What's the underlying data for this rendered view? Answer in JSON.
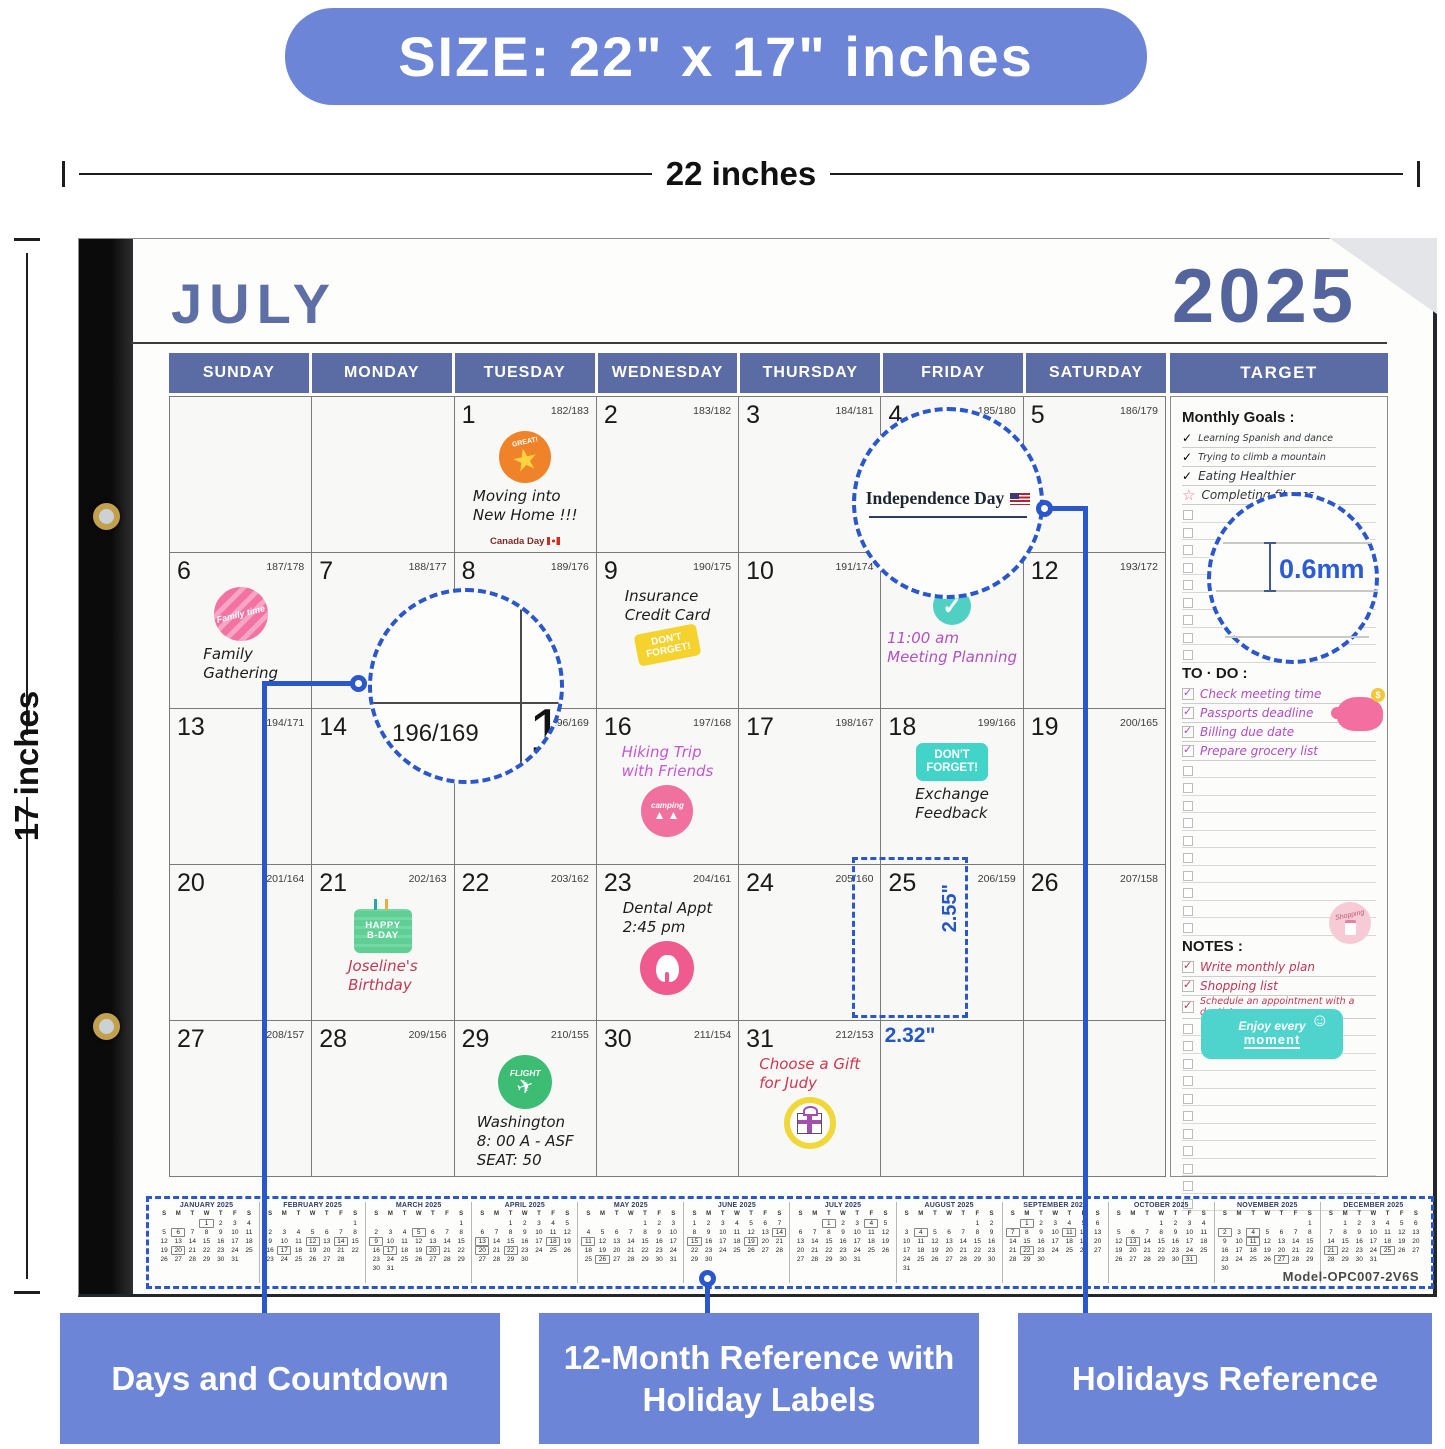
{
  "banner": {
    "text": "SIZE: 22\" x 17\" inches"
  },
  "dimensions": {
    "width_label": "22 inches",
    "height_label": "17 inches"
  },
  "calendar": {
    "month": "JULY",
    "year": "2025",
    "target_header": "TARGET",
    "day_headers": [
      "SUNDAY",
      "MONDAY",
      "TUESDAY",
      "WEDNESDAY",
      "THURSDAY",
      "FRIDAY",
      "SATURDAY"
    ],
    "weeks": [
      [
        null,
        null,
        {
          "day": "1",
          "countdown": "182/183",
          "event": {
            "sticker": "great-star",
            "lines": [
              "Moving into",
              "New Home !!!"
            ],
            "color": "#1c1c1c",
            "note": "Canada Day",
            "note_flag": "ca"
          }
        },
        {
          "day": "2",
          "countdown": "183/182"
        },
        {
          "day": "3",
          "countdown": "184/181"
        },
        {
          "day": "4",
          "countdown": "185/180"
        },
        {
          "day": "5",
          "countdown": "186/179"
        }
      ],
      [
        {
          "day": "6",
          "countdown": "187/178",
          "event": {
            "sticker": "family-time",
            "lines": [
              "Family",
              "Gathering"
            ],
            "color": "#1c1c1c"
          }
        },
        {
          "day": "7",
          "countdown": "188/177"
        },
        {
          "day": "8",
          "countdown": "189/176"
        },
        {
          "day": "9",
          "countdown": "190/175",
          "event": {
            "lines": [
              "Insurance",
              "Credit Card"
            ],
            "color": "#1c1c1c",
            "sticker": "dont-forget-yellow",
            "sticker_after": true
          }
        },
        {
          "day": "10",
          "countdown": "191/174"
        },
        {
          "day": "11",
          "countdown": "192/173",
          "event": {
            "sticker": "check-teal",
            "lines": [
              "11:00 am",
              "Meeting Planning"
            ],
            "color": "#b44fc4"
          }
        },
        {
          "day": "12",
          "countdown": "193/172"
        }
      ],
      [
        {
          "day": "13",
          "countdown": "194/171"
        },
        {
          "day": "14",
          "countdown": "195/170"
        },
        {
          "day": "15",
          "countdown": "196/169"
        },
        {
          "day": "16",
          "countdown": "197/168",
          "event": {
            "lines": [
              "Hiking Trip",
              "with Friends"
            ],
            "color": "#c455d6",
            "sticker": "camping",
            "sticker_after": true
          }
        },
        {
          "day": "17",
          "countdown": "198/167"
        },
        {
          "day": "18",
          "countdown": "199/166",
          "event": {
            "sticker": "dont-forget-teal",
            "lines": [
              "Exchange",
              "Feedback"
            ],
            "color": "#1c1c1c"
          }
        },
        {
          "day": "19",
          "countdown": "200/165"
        }
      ],
      [
        {
          "day": "20",
          "countdown": "201/164"
        },
        {
          "day": "21",
          "countdown": "202/163",
          "event": {
            "sticker": "bday-cake",
            "lines": [
              "Joseline's",
              "Birthday"
            ],
            "color": "#c13a54"
          }
        },
        {
          "day": "22",
          "countdown": "203/162"
        },
        {
          "day": "23",
          "countdown": "204/161",
          "event": {
            "lines": [
              "Dental Appt",
              "2:45 pm"
            ],
            "color": "#1c1c1c",
            "sticker": "tooth",
            "sticker_after": true
          }
        },
        {
          "day": "24",
          "countdown": "205/160"
        },
        {
          "day": "25",
          "countdown": "206/159"
        },
        {
          "day": "26",
          "countdown": "207/158"
        }
      ],
      [
        {
          "day": "27",
          "countdown": "208/157"
        },
        {
          "day": "28",
          "countdown": "209/156"
        },
        {
          "day": "29",
          "countdown": "210/155",
          "event": {
            "sticker": "flight",
            "lines": [
              "Washington",
              "8: 00 A  - ASF",
              "SEAT:  50"
            ],
            "color": "#1c1c1c"
          }
        },
        {
          "day": "30",
          "countdown": "211/154"
        },
        {
          "day": "31",
          "countdown": "212/153",
          "event": {
            "lines": [
              "Choose a Gift",
              "for Judy"
            ],
            "color": "#d2344e",
            "sticker": "gift",
            "sticker_after": true
          }
        },
        null,
        null
      ]
    ]
  },
  "target": {
    "monthly": {
      "title": "Monthly Goals :",
      "color": "#33383f",
      "empty_rows": 9,
      "items": [
        {
          "icon": "check",
          "text": "Learning Spanish and dance"
        },
        {
          "icon": "check",
          "text": "Trying to climb a mountain"
        },
        {
          "icon": "check",
          "text": "Eating Healthier"
        },
        {
          "icon": "star",
          "text": "Completing fitness"
        }
      ]
    },
    "todo": {
      "title": "TO · DO :",
      "color": "#b04cc2",
      "empty_rows": 10,
      "items": [
        "Check meeting time",
        "Passports deadline",
        "Billing due date",
        "Prepare grocery list"
      ]
    },
    "notes": {
      "title": "NOTES :",
      "color": "#c23553",
      "empty_rows": 11,
      "items": [
        "Write monthly plan",
        "Shopping list",
        "Schedule an appointment with a dentist"
      ],
      "badge": "Enjoy every moment"
    }
  },
  "annotations": {
    "independence": {
      "label": "Independence Day"
    },
    "magnifier": {
      "countdown": "196/169",
      "day": "16"
    },
    "thickness": {
      "label": "0.6mm"
    },
    "cell_size": {
      "width": "2.32\"",
      "height": "2.55\""
    },
    "callouts": [
      "Days and Countdown",
      "12-Month Reference with Holiday Labels",
      "Holidays Reference"
    ]
  },
  "mini_reference": {
    "dow": [
      "S",
      "M",
      "T",
      "W",
      "T",
      "F",
      "S"
    ],
    "model": "Model-OPC007-2V6S",
    "months": [
      {
        "name": "JANUARY 2025",
        "first": 3,
        "days": 31,
        "boxed": [
          1,
          6,
          20
        ]
      },
      {
        "name": "FEBRUARY 2025",
        "first": 6,
        "days": 28,
        "boxed": [
          12,
          14,
          17
        ]
      },
      {
        "name": "MARCH 2025",
        "first": 6,
        "days": 31,
        "boxed": [
          5,
          9,
          17,
          20
        ]
      },
      {
        "name": "APRIL 2025",
        "first": 2,
        "days": 30,
        "boxed": [
          13,
          18,
          20,
          22
        ]
      },
      {
        "name": "MAY 2025",
        "first": 4,
        "days": 31,
        "boxed": [
          11,
          26
        ]
      },
      {
        "name": "JUNE 2025",
        "first": 0,
        "days": 30,
        "boxed": [
          14,
          15,
          19
        ]
      },
      {
        "name": "JULY 2025",
        "first": 2,
        "days": 31,
        "boxed": [
          1,
          4
        ]
      },
      {
        "name": "AUGUST 2025",
        "first": 5,
        "days": 31,
        "boxed": [
          4
        ]
      },
      {
        "name": "SEPTEMBER 2025",
        "first": 1,
        "days": 30,
        "boxed": [
          1,
          7,
          11,
          22
        ]
      },
      {
        "name": "OCTOBER 2025",
        "first": 3,
        "days": 31,
        "boxed": [
          13,
          31
        ]
      },
      {
        "name": "NOVEMBER 2025",
        "first": 6,
        "days": 30,
        "boxed": [
          2,
          4,
          11,
          27
        ]
      },
      {
        "name": "DECEMBER 2025",
        "first": 1,
        "days": 31,
        "boxed": [
          21,
          25
        ]
      }
    ]
  }
}
